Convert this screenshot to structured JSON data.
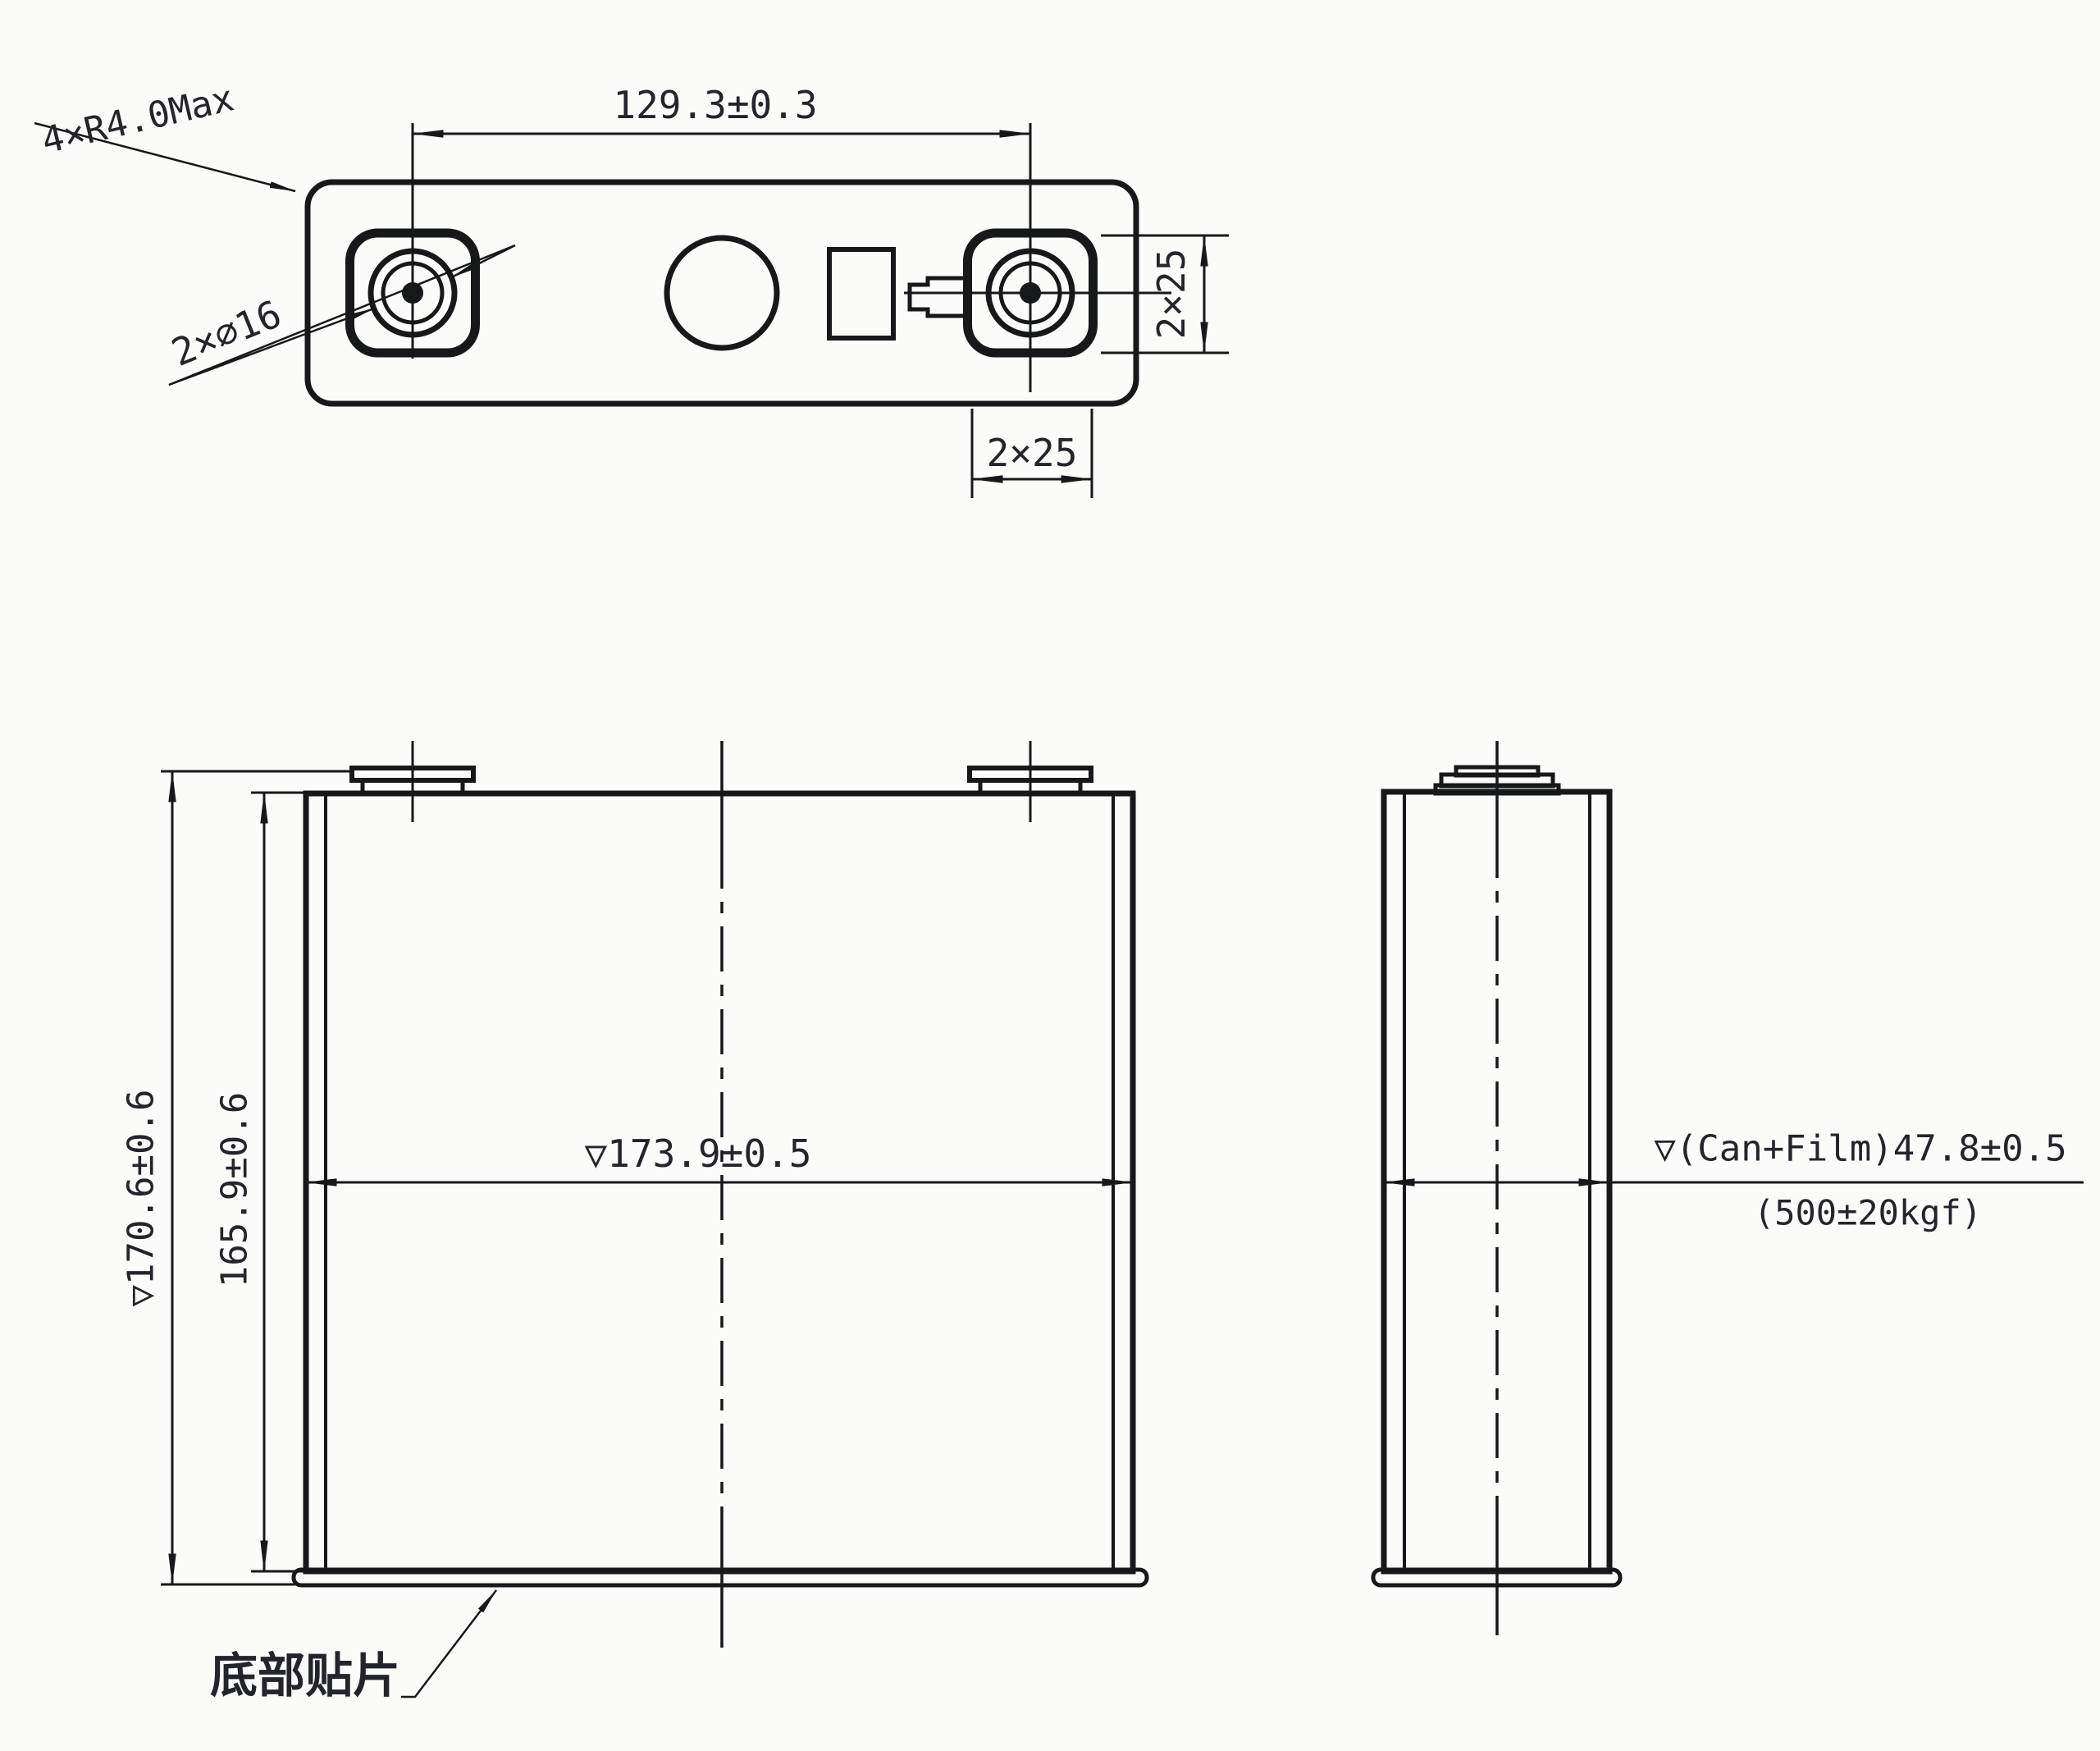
{
  "top_view": {
    "corner_note": "4×R4.0Max",
    "terminal_diameter": "2×∅16",
    "terminal_pitch": "129.3±0.3",
    "pad_height": "2×25",
    "pad_width": "2×25"
  },
  "front_view": {
    "overall_height": "▽170.6±0.6",
    "can_height": "165.9±0.6",
    "cell_width": "▽173.9±0.5",
    "bottom_patch_label": "底部贴片"
  },
  "side_view": {
    "thickness": "▽(Can+Film)47.8±0.5",
    "thickness_condition": "(500±20kgf)"
  },
  "colors": {
    "line": "#17181a",
    "text": "#23252b",
    "background": "#fbfbfa"
  }
}
